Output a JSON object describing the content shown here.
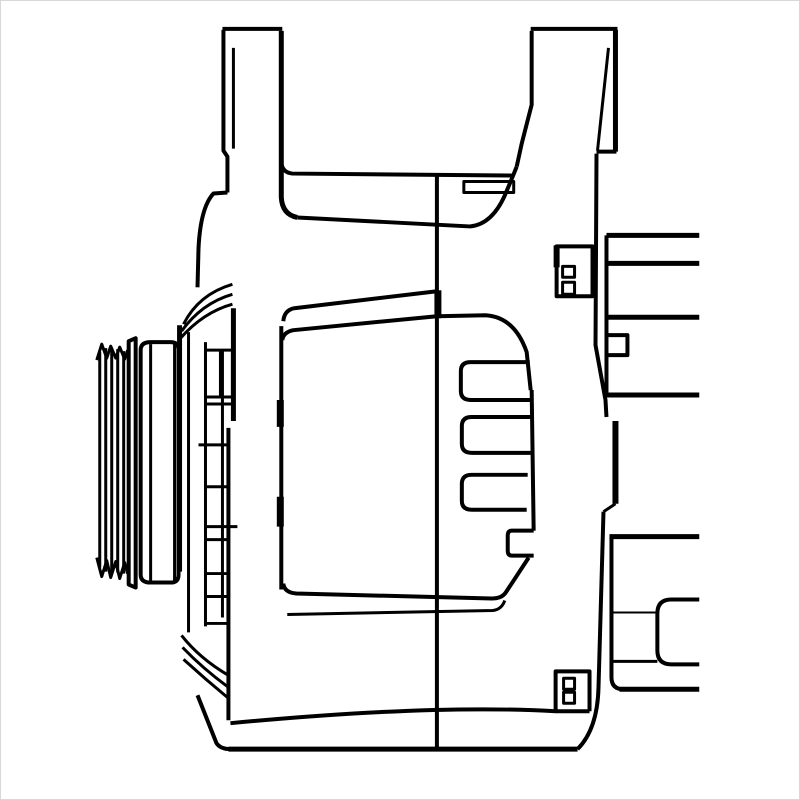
{
  "meta": {
    "description": "black-and-white technical line drawing of an alternator, side view",
    "background_color": "#ffffff",
    "line_color": "#000000",
    "border_color": "#d8d8d8",
    "canvas": {
      "width": 800,
      "height": 800
    }
  },
  "parts": [
    {
      "name": "pulley-rib-lines",
      "w": 3,
      "d": "M99,352 L99,568 M105,348 L105,572 M111,350 L111,574 M117,349 L117,573 M123,351 L123,574"
    },
    {
      "name": "pulley-rib-top-zigzag",
      "w": 3,
      "d": "M96,360 L101,344 L106,358 L110,346 L115,358 L119,347 L124,359 L127,350"
    },
    {
      "name": "pulley-rib-bottom-zigzag",
      "w": 3,
      "d": "M96,558 L101,577 L106,561 L110,578 L115,562 L119,579 L124,563 L127,574"
    },
    {
      "name": "pulley-step-block",
      "w": 4,
      "d": "M135,338 L135,588 L128,585 L128,341 Z"
    },
    {
      "name": "pulley-hub-face",
      "w": 4,
      "d": "M150,342 L170,342 Q178,342 178,350 L178,575 Q178,583 170,583 L150,583 Q140,583 140,575 L140,350 Q140,342 150,342 Z"
    },
    {
      "name": "pulley-hub-inner-lines",
      "w": 3,
      "d": "M150,344 L150,581 M174,344 L174,581"
    },
    {
      "name": "front-housing-left-edge",
      "w": 5,
      "d": "M179,325 L179,572"
    },
    {
      "name": "front-housing-dome",
      "w": 4,
      "d": "M227,192 L213,193 Q200,207 198,248 L197,287"
    },
    {
      "name": "front-housing-top-arcs",
      "w": 3,
      "d": "M232,284 Q198,294 183,324 M232,294 Q201,303 181,331 M232,304 Q203,312 180,338"
    },
    {
      "name": "front-housing-verticals",
      "w": 3,
      "d": "M188,332 L188,633 M205,342 L205,627 M222,350 L222,618"
    },
    {
      "name": "front-housing-right-edge-upper",
      "w": 5,
      "d": "M233,308 L233,421"
    },
    {
      "name": "front-housing-right-edge-lower",
      "w": 4,
      "d": "M228,428 L228,721"
    },
    {
      "name": "front-housing-slot-box",
      "w": 3,
      "d": "M205,350 L232,350 L232,397 L205,397 Z M220,350 L220,397"
    },
    {
      "name": "front-housing-rib-rungs",
      "w": 3,
      "d": "M205,404 L233,404 M198,445 L228,445 M205,487 L228,487 M205,527 L237,527 M205,540 L228,540 M204,574 L228,574 M205,597 L228,597 M206,624 L228,624"
    },
    {
      "name": "front-housing-bottom-arcs",
      "w": 3,
      "d": "M181,636 Q199,659 228,676 M182,648 Q202,669 228,688 M183,660 Q205,680 228,699"
    },
    {
      "name": "front-housing-foot",
      "w": 4,
      "d": "M197,696 L216,744 Q220,750 230,750"
    },
    {
      "name": "bracket-left-lug-top",
      "w": 4,
      "d": "M222,28 L282,28"
    },
    {
      "name": "bracket-left-lug-left-edge",
      "w": 4,
      "d": "M223,29 L223,150 L227,156 L227,192"
    },
    {
      "name": "bracket-left-lug-inner-line",
      "w": 3,
      "d": "M233,47 L233,148"
    },
    {
      "name": "bracket-left-lug-right-edge",
      "w": 5,
      "d": "M281,30 L281,197 Q282,214 297,217"
    },
    {
      "name": "bracket-beam-top",
      "w": 4,
      "d": "M281,162 Q282,172 292,173 L514,175"
    },
    {
      "name": "bracket-beam-bottom",
      "w": 4,
      "d": "M297,217 L470,226 Q492,224 505,195 Q511,181 517,166"
    },
    {
      "name": "bracket-beam-step-bar",
      "w": 3,
      "d": "M464,181 L514,181 L514,192 L464,192 Z"
    },
    {
      "name": "bracket-right-arm-left-edge",
      "w": 4,
      "d": "M517,166 L522,143 L532,104 L532,30"
    },
    {
      "name": "bracket-right-lug-top",
      "w": 4,
      "d": "M531,28 L618,28"
    },
    {
      "name": "bracket-right-lug-right-edge",
      "w": 5,
      "d": "M616,29 L616,151"
    },
    {
      "name": "bracket-right-lug-bottom",
      "w": 4,
      "d": "M617,151 L597,151"
    },
    {
      "name": "bracket-right-lug-inner-line",
      "w": 3,
      "d": "M609,47 L598,150"
    },
    {
      "name": "housing-center-split-line",
      "w": 4,
      "d": "M437,174 L437,750"
    },
    {
      "name": "housing-center-split-thick",
      "w": 7,
      "d": "M438,290 L438,318"
    },
    {
      "name": "rear-housing-left-edge",
      "w": 4,
      "d": "M281,326 L281,590"
    },
    {
      "name": "rear-housing-left-edge-marks",
      "w": 7,
      "d": "M280,400 L280,427 M280,497 L280,527"
    },
    {
      "name": "rear-housing-top-outer",
      "w": 4,
      "d": "M283,321 Q284,310 294,308 L437,291"
    },
    {
      "name": "rear-housing-top-inner",
      "w": 4,
      "d": "M282,340 Q283,332 293,330 L437,316 L486,315 Q515,317 527,352 L531,390"
    },
    {
      "name": "rear-housing-right-edge",
      "w": 4,
      "d": "M532,390 L534,531"
    },
    {
      "name": "rear-housing-notch",
      "w": 4,
      "d": "M534,531 L512,531 Q508,531 508,536 L508,551 Q508,556 512,556 L534,556"
    },
    {
      "name": "rear-housing-bottom-outer",
      "w": 4,
      "d": "M529,558 L506,593 Q502,599 492,599 L296,594 Q284,593 283,584"
    },
    {
      "name": "rear-housing-bottom-inner",
      "w": 3,
      "d": "M287,615 L493,611 Q502,610 505,601"
    },
    {
      "name": "vent-slot-1",
      "w": 4,
      "d": "M530,362 L471,362 Q461,362 461,371 L461,391 Q461,400 471,400 L531,400"
    },
    {
      "name": "vent-slot-2",
      "w": 4,
      "d": "M531,417 L472,417 Q462,417 462,426 L462,444 Q462,453 472,453 L531,453"
    },
    {
      "name": "vent-slot-3",
      "w": 4,
      "d": "M528,475 L472,475 Q462,475 462,484 L462,501 Q462,510 472,510 L527,510"
    },
    {
      "name": "flange-edge-upper",
      "w": 4,
      "d": "M597,153 L596,345 L606,400 L607,417"
    },
    {
      "name": "flange-edge-thick",
      "w": 6,
      "d": "M616,421 L616,504"
    },
    {
      "name": "flange-edge-step",
      "w": 3,
      "d": "M616,504 L604,512"
    },
    {
      "name": "flange-edge-lower",
      "w": 4,
      "d": "M604,512 L599,688 Q598,730 578,750"
    },
    {
      "name": "flange-tab-top",
      "w": 4,
      "d": "M557,246 L557,296 L593,296 L593,246 Z"
    },
    {
      "name": "flange-tab-top-edge-thick",
      "w": 6,
      "d": "M557,245 L557,267"
    },
    {
      "name": "flange-tab-top-teeth",
      "w": 3,
      "d": "M563,266 L575,266 L575,277 L563,277 Z M563,282 L575,282 L575,294 L563,294 Z"
    },
    {
      "name": "flange-tab-bottom",
      "w": 4,
      "d": "M556,712 L556,672 L590,672 L590,712"
    },
    {
      "name": "flange-tab-bottom-teeth",
      "w": 3,
      "d": "M564,679 L575,679 L575,690 L564,690 Z M564,693 L575,693 L575,704 L564,704 Z"
    },
    {
      "name": "body-bottom-slope-line",
      "w": 4,
      "d": "M230,724 Q430,705 556,712 L590,712"
    },
    {
      "name": "body-bottom-line",
      "w": 5,
      "d": "M228,750 L578,750"
    },
    {
      "name": "engine-block-top-lines",
      "w": 5,
      "d": "M607,235 L700,235 M607,263 L700,263 M607,317 L700,317 M607,395 L700,395"
    },
    {
      "name": "engine-block-top-left-edge",
      "w": 4,
      "d": "M607,235 L607,395"
    },
    {
      "name": "engine-block-top-notch",
      "w": 4,
      "d": "M607,335 L628,335 L628,355 L607,355"
    },
    {
      "name": "engine-block-bottom-top-line",
      "w": 5,
      "d": "M610,537 L700,537"
    },
    {
      "name": "engine-block-bottom-left-edge",
      "w": 4,
      "d": "M612,537 L612,678 Q612,690 624,690"
    },
    {
      "name": "engine-block-bottom-line",
      "w": 5,
      "d": "M620,690 L700,690"
    },
    {
      "name": "engine-block-bottom-thin-line",
      "w": 2,
      "d": "M612,613 L658,613"
    },
    {
      "name": "engine-block-bottom-inner-shape",
      "w": 4,
      "d": "M700,600 L672,600 Q658,600 658,614 L658,651 Q658,665 672,665 L700,665"
    },
    {
      "name": "engine-block-bottom-inner-line",
      "w": 3,
      "d": "M612,662 L658,662"
    }
  ]
}
